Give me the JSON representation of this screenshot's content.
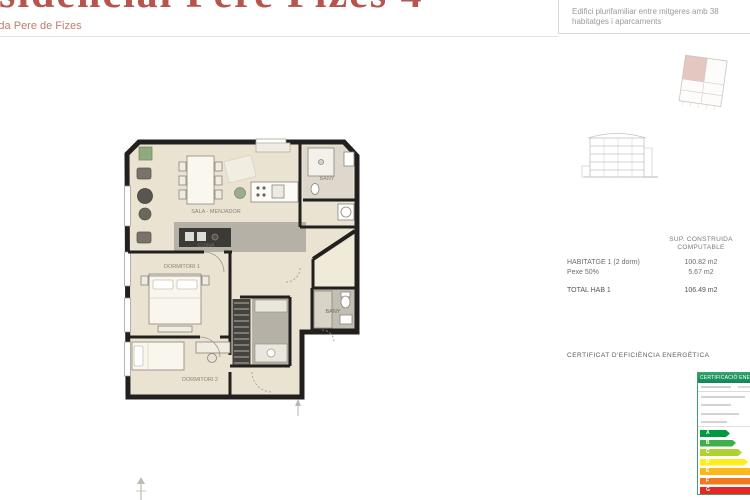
{
  "header": {
    "title": "Residencial Pere Fizes 4",
    "subtitle": "Avinguda Pere de Fizes",
    "description_line1": "Edifici plurifamiliar entre mitgeres amb 38",
    "description_line2": "habitatges i aparcaments"
  },
  "surface_table": {
    "header_line1": "SUP. CONSTRUIDA",
    "header_line2": "COMPUTABLE",
    "rows": [
      {
        "label": "HABITATGE 1 (2 dorm)",
        "value": "100.82 m2"
      },
      {
        "label": "Pexe 50%",
        "value": "5.67 m2"
      },
      {
        "label": "TOTAL HAB 1",
        "value": "106.49 m2"
      }
    ]
  },
  "energy_section": {
    "heading": "CERTIFICAT D'EFICIÈNCIA ENERGÈTICA",
    "label_title": "CERTIFICACIÓ ENERGÈTICA",
    "scale": [
      {
        "letter": "A",
        "color": "#009a44",
        "width": 30
      },
      {
        "letter": "B",
        "color": "#3fae49",
        "width": 36
      },
      {
        "letter": "C",
        "color": "#afd136",
        "width": 42
      },
      {
        "letter": "D",
        "color": "#fded1c",
        "width": 48
      },
      {
        "letter": "E",
        "color": "#fbb817",
        "width": 54
      },
      {
        "letter": "F",
        "color": "#f0781f",
        "width": 60
      },
      {
        "letter": "G",
        "color": "#e52528",
        "width": 66
      }
    ]
  },
  "plan": {
    "labels": [
      {
        "text": "SALA - MENJADOR"
      },
      {
        "text": "CUINA"
      },
      {
        "text": "DORMITORI 1"
      },
      {
        "text": "DORMITORI 2"
      },
      {
        "text": "BANY"
      },
      {
        "text": "BANY"
      }
    ],
    "colors": {
      "floor": "#ebe3d2",
      "tile": "#b6b1a7",
      "wall": "#21201e"
    }
  }
}
